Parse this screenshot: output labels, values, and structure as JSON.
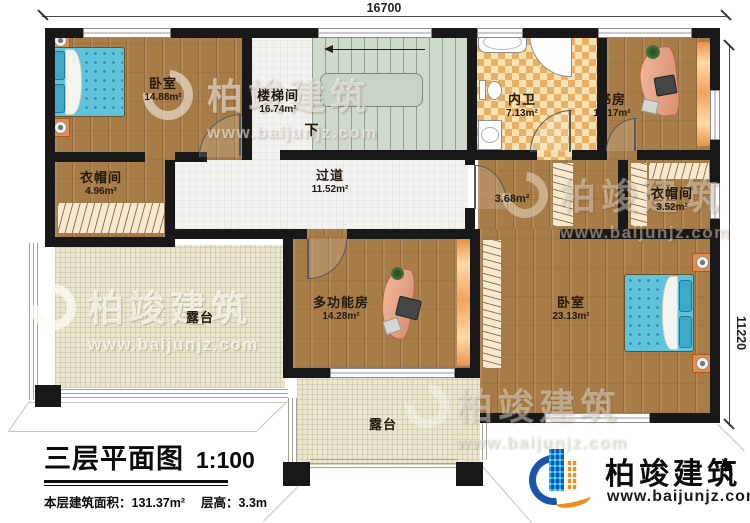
{
  "dimensions": {
    "top": "16700",
    "right": "11220"
  },
  "rooms": [
    {
      "name": "卧室",
      "area": "14.88m²"
    },
    {
      "name": "衣帽间",
      "area": "4.96m²"
    },
    {
      "name": "楼梯间",
      "area": "16.74m²"
    },
    {
      "name": "内卫",
      "area": "7.13m²"
    },
    {
      "name": "书房",
      "area": "13.17m²"
    },
    {
      "name": "过道",
      "area": "11.52m²"
    },
    {
      "name": "",
      "area": "3.68m²"
    },
    {
      "name": "衣帽间",
      "area": "3.52m²"
    },
    {
      "name": "多功能房",
      "area": "14.28m²"
    },
    {
      "name": "卧室",
      "area": "23.13m²"
    },
    {
      "name": "露台",
      "area": ""
    },
    {
      "name": "露台",
      "area": ""
    }
  ],
  "stairs": {
    "down_label": "下"
  },
  "title_block": {
    "title": "三层平面图",
    "scale": "1:100",
    "floor_area": "本层建筑面积：131.37m²",
    "floor_height": "层高：3.3m"
  },
  "brand": {
    "name": "柏竣建筑",
    "website": "www.baijunjz.com",
    "blue": "#1956a8",
    "orange": "#f08f1c"
  },
  "watermark": {
    "text": "柏竣建筑",
    "website": "www.baijunjz.com"
  }
}
